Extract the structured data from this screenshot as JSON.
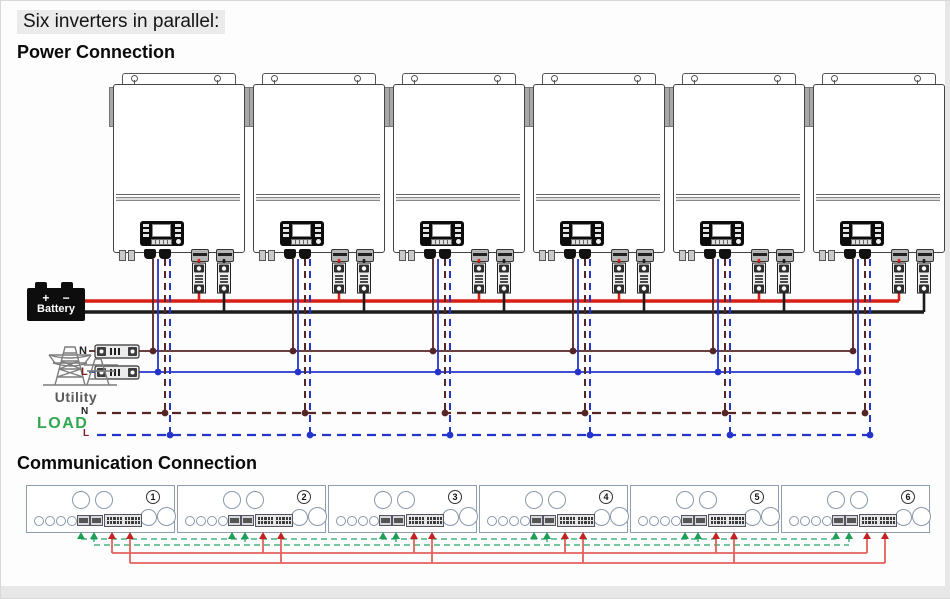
{
  "page": {
    "title": "Six inverters in parallel:",
    "power_heading": "Power Connection",
    "comm_heading": "Communication Connection"
  },
  "power": {
    "inverter_count": 6,
    "battery": {
      "label": "Battery",
      "plus": "+",
      "minus": "−"
    },
    "utility": {
      "label": "Utility",
      "neutral_label": "N",
      "line_label": "L"
    },
    "load": {
      "label": "LOAD",
      "neutral_label": "N",
      "line_label": "L"
    },
    "colors": {
      "battery_positive": "#d71f14",
      "battery_negative": "#1c1c1c",
      "ac_neutral": "#552424",
      "ac_line": "#2535cc",
      "load_text": "#2fa84f"
    }
  },
  "communication": {
    "panels": [
      {
        "number": "1"
      },
      {
        "number": "2"
      },
      {
        "number": "3"
      },
      {
        "number": "4"
      },
      {
        "number": "5"
      },
      {
        "number": "6"
      }
    ],
    "colors": {
      "signal_cable_green": "#46b482",
      "signal_arrow_green": "#1f9e55",
      "comm_cable_red": "#e2605c",
      "comm_arrow_red": "#c42222"
    }
  }
}
